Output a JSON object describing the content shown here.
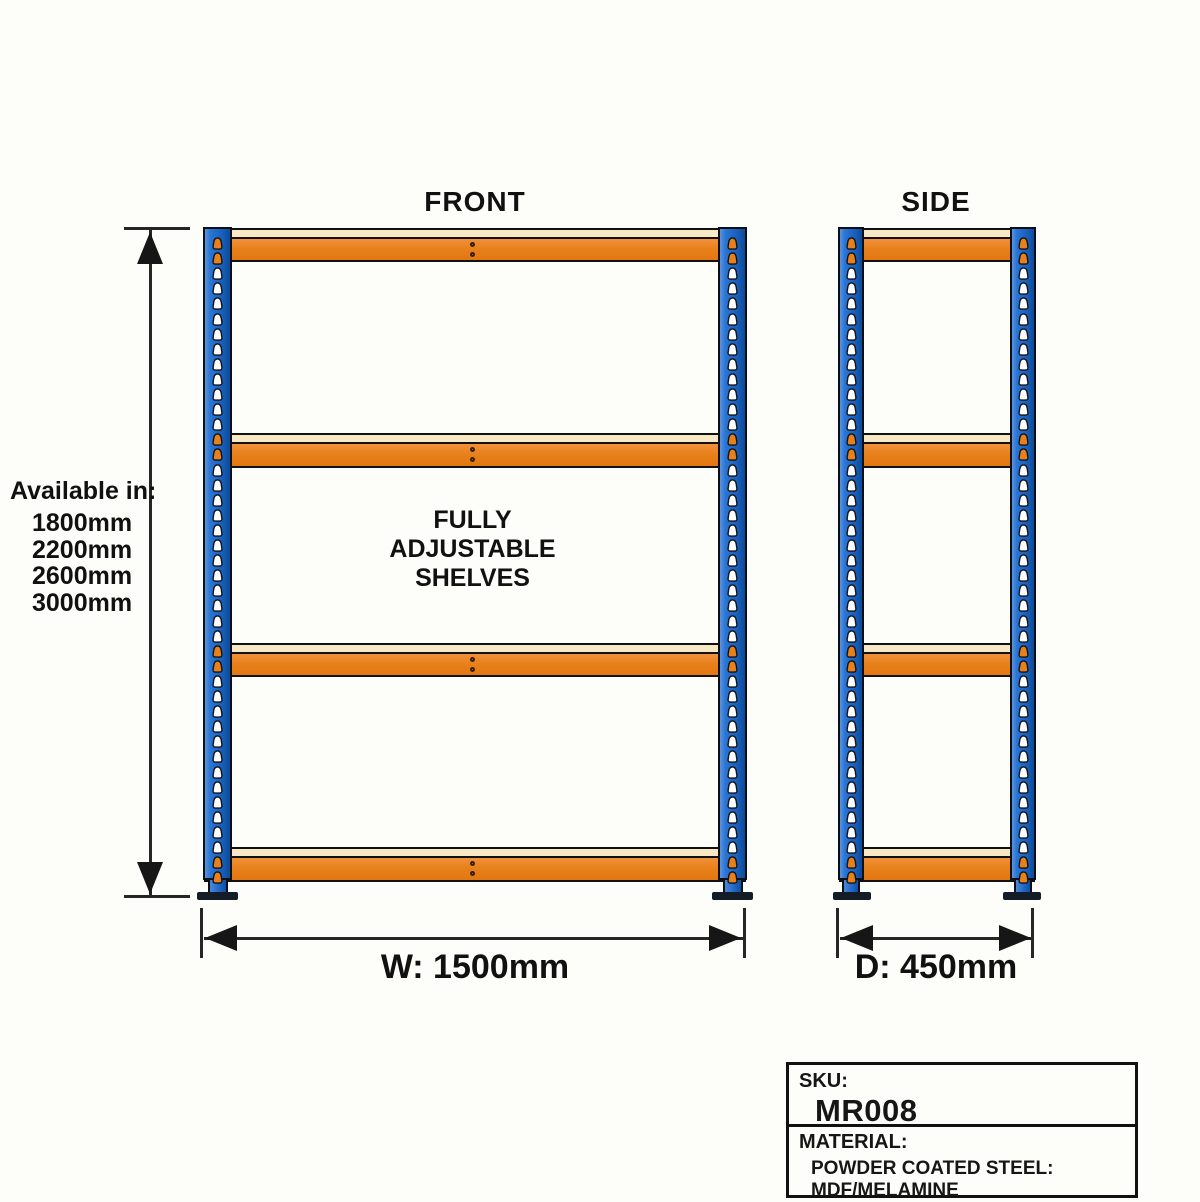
{
  "titles": {
    "front": "FRONT",
    "side": "SIDE"
  },
  "available": {
    "heading": "Available in:",
    "sizes": [
      "1800mm",
      "2200mm",
      "2600mm",
      "3000mm"
    ]
  },
  "center_note": {
    "line1": "FULLY",
    "line2": "ADJUSTABLE",
    "line3": "SHELVES"
  },
  "dimensions": {
    "width_label": "W: 1500mm",
    "depth_label": "D: 450mm"
  },
  "info_box": {
    "sku_heading": "SKU:",
    "sku_value": "MR008",
    "material_heading": "MATERIAL:",
    "material_value": "POWDER COATED STEEL: MDF/MELAMINE"
  },
  "colors": {
    "upright_blue": "#1d66c6",
    "beam_orange": "#e8811c",
    "shelf_cream": "#f7e9c6",
    "outline": "#111111",
    "hole_white": "#ffffff"
  }
}
